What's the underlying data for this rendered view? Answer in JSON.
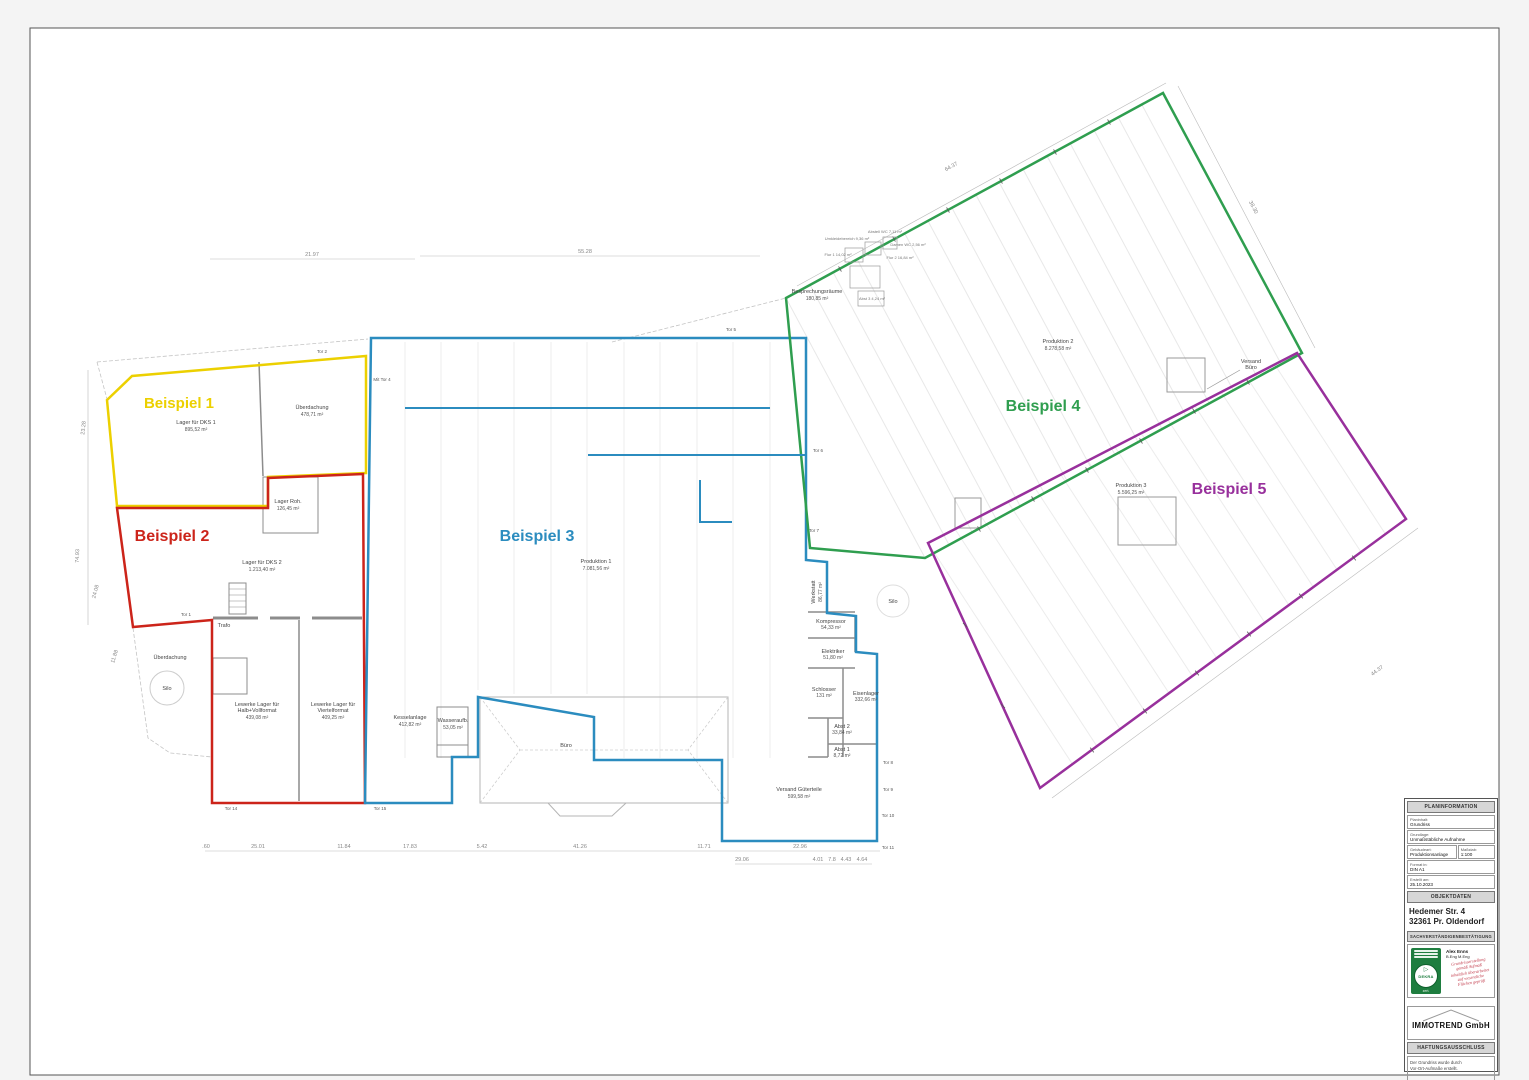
{
  "zones": [
    {
      "label": "Beispiel 1",
      "color": "#ecd000"
    },
    {
      "label": "Beispiel 2",
      "color": "#cc241a"
    },
    {
      "label": "Beispiel 3",
      "color": "#2b8cbf"
    },
    {
      "label": "Beispiel 4",
      "color": "#2f9e4f"
    },
    {
      "label": "Beispiel 5",
      "color": "#98309c"
    }
  ],
  "rooms": [
    {
      "n": "Lager für DKS 1",
      "a": "895,52 m²"
    },
    {
      "n": "Überdachung",
      "a": "478,71 m²"
    },
    {
      "n": "Lager Roh.",
      "a": "126,45 m²"
    },
    {
      "n": "Lager für DKS 2",
      "a": "1.213,40 m²"
    },
    {
      "n": "Trafo"
    },
    {
      "n": "Lewerke Lager für",
      "n2": "Halb+Vollformat",
      "a": "439,08 m²"
    },
    {
      "n": "Lewerke Lager für",
      "n2": "Viertelformat",
      "a": "409,25 m²"
    },
    {
      "n": "Überdachung"
    },
    {
      "n": "Silo"
    },
    {
      "n": "Produktion 1",
      "a": "7.081,56 m²"
    },
    {
      "n": "Kesselanlage",
      "a": "412,82 m²"
    },
    {
      "n": "Wasseraufb.",
      "a": "53,05 m²"
    },
    {
      "n": "Büro"
    },
    {
      "n": "Versand Güterteile",
      "a": "599,58 m²"
    },
    {
      "n": "Werkstatt",
      "a": "86,77 m²"
    },
    {
      "n": "Kompressor",
      "a": "54,33 m²"
    },
    {
      "n": "Elektriker",
      "a": "51,80 m²"
    },
    {
      "n": "Schlosser",
      "a": "131 m²"
    },
    {
      "n": "Eisenlager",
      "a": "332,66 m²"
    },
    {
      "n": "Abst 2",
      "a": "33,84 m²"
    },
    {
      "n": "Abst 1",
      "a": "8,72 m²"
    },
    {
      "n": "Produktion 2",
      "a": "8.278,58 m²"
    },
    {
      "n": "Besprechungsräume",
      "a": "180,85 m²"
    },
    {
      "n": "Versand",
      "n2": "Büro"
    },
    {
      "n": "Produktion 3",
      "a": "5.596,25 m²"
    },
    {
      "n": "Silo"
    }
  ],
  "cluster": [
    "Umkleidebereich 9,36 m²",
    "Abstell WC 7,11 m²",
    "Damen WC 2,56 m²",
    "Flur 1 14,02 m²",
    "Flur 2 16,84 m²",
    "Abst 3 4,24 m²"
  ],
  "tors": [
    "Tor 1",
    "Tor 2",
    "Mit Tor 4",
    "Tor 5",
    "Tor 6",
    "Tor 7",
    "Tor 8",
    "Tor 9",
    "Tor 10",
    "Tor 11",
    "Tor 14",
    "Tor 15"
  ],
  "dims": [
    "21.97",
    "55.28",
    "64.37",
    "38.30",
    "44.37",
    "23.28",
    "74.93",
    "24.08",
    "11.88",
    ".60",
    "25.01",
    "11.84",
    "17.83",
    "5.42",
    "41.26",
    "11.71",
    "22.96",
    "29.06",
    "4.01",
    "7.8",
    "4.43",
    "4.64"
  ],
  "titleblock": {
    "h1": "PLANINFORMATION",
    "rows": [
      {
        "l": "Planinhalt:",
        "v": "Grundriss"
      },
      {
        "l": "Grundlage:",
        "v": "Unmaßstäbliche Aufnahme"
      },
      {
        "l": "Gebäudeart:",
        "v": "Produktionsanlage",
        "l2": "Maßstab:",
        "v2": "1:100"
      },
      {
        "l": "Format in:",
        "v": "DIN A1"
      },
      {
        "l": "Erstellt am:",
        "v": "25.10.2023"
      }
    ],
    "h2": "OBJEKTDATEN",
    "address1": "Hedemer Str. 4",
    "address2": "32361 Pr. Oldendorf",
    "h3": "SACHVERSTÄNDIGENBESTÄTIGUNG",
    "stamp": {
      "seal": "DEKRA",
      "seal_sub": "zert.",
      "name": "Alex Enns",
      "degree": "B.Eng M.Eng",
      "notes": [
        "Grundrisserstellung",
        "gemäß Aufmaß",
        "inhaltlich überarbeitet",
        "auf wesentliche",
        "Flächen geprüft"
      ]
    },
    "company": "IMMOTREND GmbH",
    "h4": "HAFTUNGSAUSSCHLUSS",
    "disclaimer1": "Der Grundriss wurde durch",
    "disclaimer2": "Vor-Ort-Aufmaße erstellt."
  }
}
